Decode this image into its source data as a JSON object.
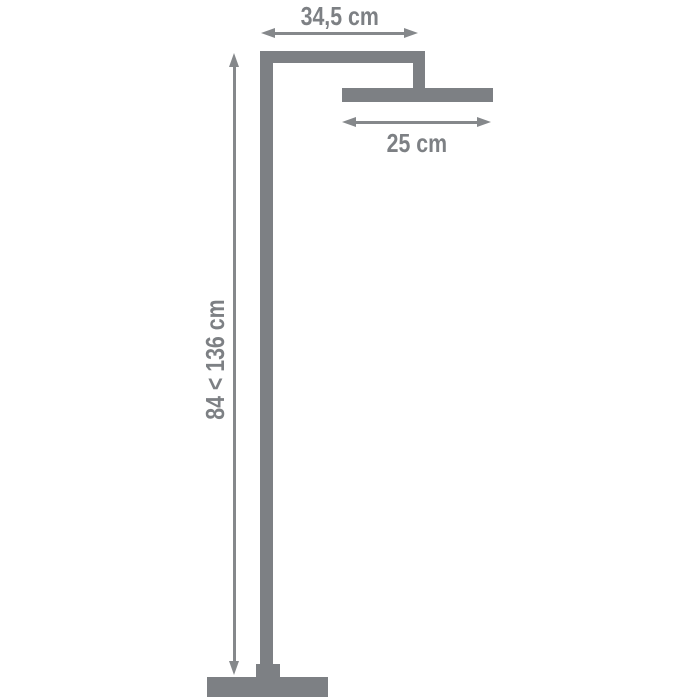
{
  "diagram": {
    "kind": "product-dimension-diagram",
    "labels": {
      "top_width": "34,5 cm",
      "head_width": "25 cm",
      "height_range": "84 < 136 cm"
    },
    "values": {
      "top_width_cm": 34.5,
      "head_width_cm": 25,
      "height_min_cm": 84,
      "height_max_cm": 136,
      "unit": "cm"
    },
    "colors": {
      "shape_gray": "#7d8084",
      "arrow_gray": "#85888b",
      "label_gray": "#7d8084",
      "background": "#ffffff"
    }
  }
}
